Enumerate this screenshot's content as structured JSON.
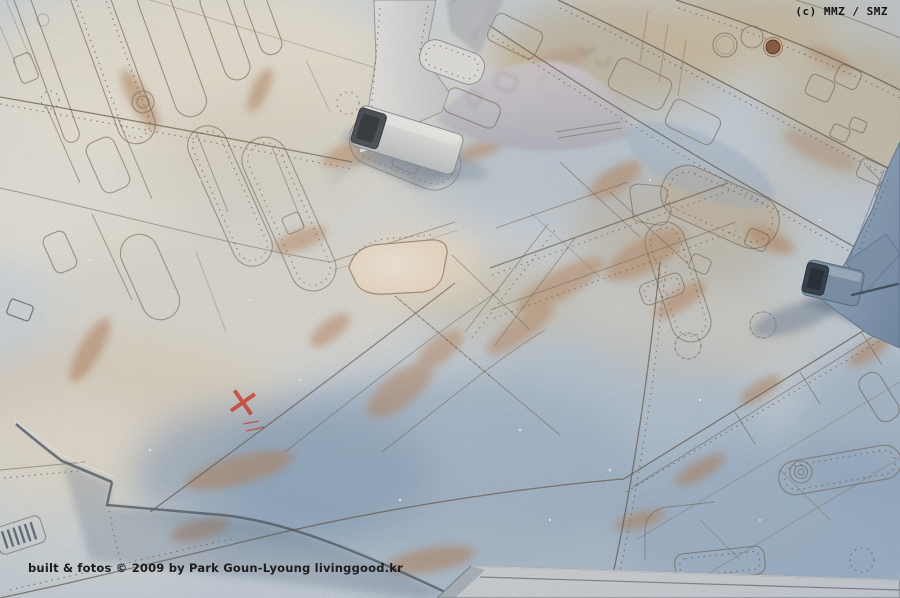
{
  "overlays": {
    "watermark_top_right": "(c) MMZ / SMZ",
    "caption_bottom_left": "built & fotos © 2009 by Park Goun-Lyoung livinggood.kr"
  },
  "scene": {
    "description": "Macro photograph of a scale model aircraft upper wing and twin-tail fuselage surface with engraved panel lines, rivet rows, rust weathering and two vertical fin bases",
    "markings": {
      "red_cross_symbol": "✕"
    },
    "palette": {
      "base_blue": "#ccd8e2",
      "pale_cream": "#f1ebdb",
      "sand_tan": "#c9b288",
      "rust": "#b9835a",
      "shadow_blue": "#9cb3cc",
      "panel_line_brown": "#6f5f4e",
      "fin_white": "#eceae6",
      "fin_blue": "#8aa2bc",
      "marking_red": "#d43527",
      "text_black": "#151515"
    }
  }
}
